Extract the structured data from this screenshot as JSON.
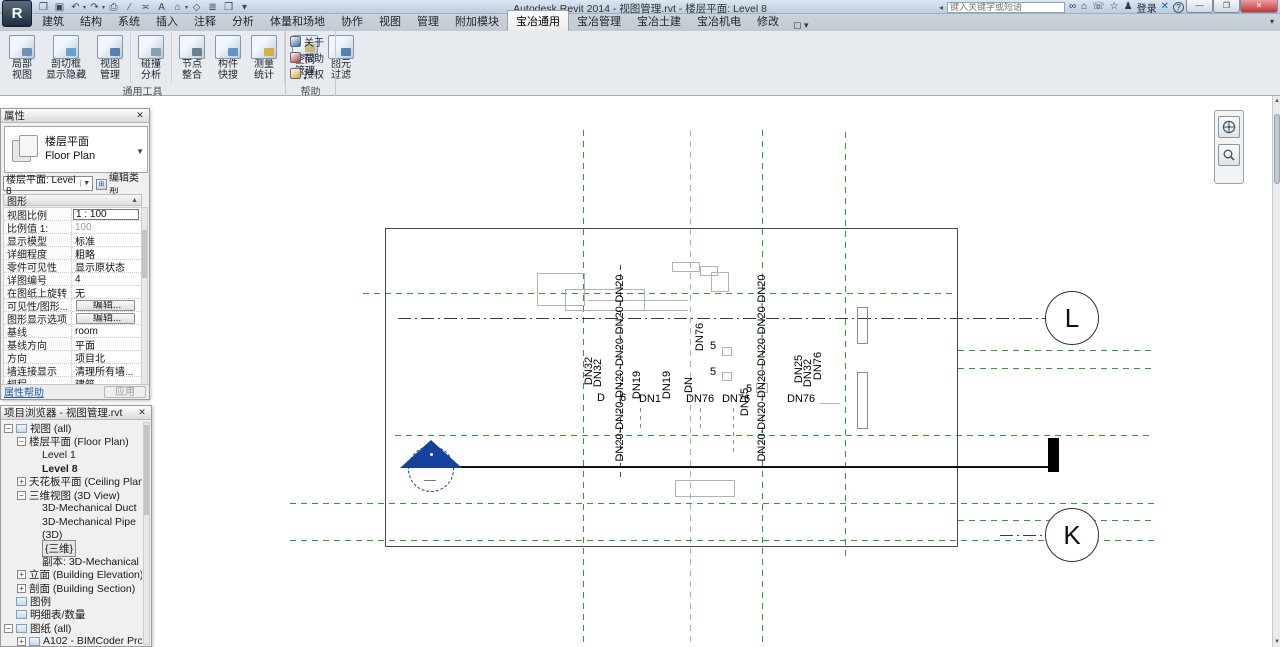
{
  "window": {
    "title": "Autodesk Revit 2014 -    视图管理.rvt - 楼层平面: Level 8",
    "logo_letter": "R",
    "search_placeholder": "键入关键字或短语",
    "signin_label": "登录",
    "min_glyph": "—",
    "max_glyph": "❐",
    "close_glyph": "✕"
  },
  "qat": {
    "icons": [
      {
        "name": "open-file",
        "glyph": "❒"
      },
      {
        "name": "save",
        "glyph": "▣"
      },
      {
        "name": "undo",
        "glyph": "↶",
        "dd": true
      },
      {
        "name": "redo",
        "glyph": "↷",
        "dd": true
      },
      {
        "name": "print",
        "glyph": "⎙"
      },
      {
        "name": "measure",
        "glyph": "∕"
      },
      {
        "name": "aligned-dimension",
        "glyph": "≍"
      },
      {
        "name": "text",
        "glyph": "A"
      },
      {
        "name": "default-3d-view",
        "glyph": "⌂",
        "dd": true
      },
      {
        "name": "section",
        "glyph": "◇"
      },
      {
        "name": "thin-lines",
        "glyph": "≣"
      },
      {
        "name": "close-hidden-windows",
        "glyph": "❐"
      },
      {
        "name": "customize-quick-access",
        "glyph": "▾"
      }
    ]
  },
  "infocenter": {
    "icons": [
      {
        "name": "search",
        "glyph": "∞"
      },
      {
        "name": "subscription-center",
        "glyph": "⌂"
      },
      {
        "name": "communication-center",
        "glyph": "☏"
      },
      {
        "name": "favorites",
        "glyph": "☆"
      },
      {
        "name": "sign-in-avatar",
        "glyph": "♟"
      }
    ],
    "help_glyph": "?"
  },
  "tabs": [
    {
      "label": "建筑"
    },
    {
      "label": "结构"
    },
    {
      "label": "系统"
    },
    {
      "label": "插入"
    },
    {
      "label": "注释"
    },
    {
      "label": "分析"
    },
    {
      "label": "体量和场地"
    },
    {
      "label": "协作"
    },
    {
      "label": "视图"
    },
    {
      "label": "管理"
    },
    {
      "label": "附加模块"
    },
    {
      "label": "宝冶通用",
      "active": true
    },
    {
      "label": "宝冶管理"
    },
    {
      "label": "宝冶土建"
    },
    {
      "label": "宝冶机电"
    },
    {
      "label": "修改"
    }
  ],
  "tab_extra_glyph": "▢ ▾",
  "ribbon_min_glyph": "▾",
  "ribbon": {
    "panels": [
      {
        "name": "通用工具",
        "groups": [
          [
            {
              "name": "partial-view",
              "l1": "局部",
              "l2": "视图",
              "accent": "#5b84ad"
            },
            {
              "name": "section-box-visibility",
              "l1": "剖切框",
              "l2": "显示隐藏",
              "accent": "#4e9ad0",
              "wide": true
            },
            {
              "name": "view-manager",
              "l1": "视图",
              "l2": "管理",
              "accent": "#3f6fa8"
            }
          ],
          [
            {
              "name": "clash-analysis",
              "l1": "碰撞",
              "l2": "分析",
              "accent": "#7d93a8"
            }
          ],
          [
            {
              "name": "node-integration",
              "l1": "节点",
              "l2": "整合",
              "accent": "#5d6d7c"
            },
            {
              "name": "component-quick-search",
              "l1": "构件",
              "l2": "快搜",
              "accent": "#4c86c0"
            },
            {
              "name": "measure-statistics",
              "l1": "测量",
              "l2": "统计",
              "accent": "#d8a62a"
            }
          ],
          [
            {
              "name": "space-management",
              "l1": "空间",
              "l2": "管理",
              "accent": "#c9b06a",
              "dropdown": true
            },
            {
              "name": "element-filter",
              "l1": "图元",
              "l2": "过滤",
              "accent": "#3f6fa8"
            }
          ]
        ]
      },
      {
        "name": "帮助",
        "small_buttons": [
          {
            "name": "about",
            "label": "关于",
            "color": "#2f6fb5"
          },
          {
            "name": "help",
            "label": "帮助",
            "color": "#b03a2e"
          },
          {
            "name": "license",
            "label": "授权",
            "color": "#d8a62a"
          }
        ]
      }
    ]
  },
  "properties": {
    "title": "属性",
    "close_glyph": "✕",
    "type_cn": "楼层平面",
    "type_en": "Floor Plan",
    "selector_value": "楼层平面: Level 8",
    "edit_type_label": "编辑类型",
    "section_graphics": "图形",
    "rows": [
      {
        "label": "视图比例",
        "value": "1 : 100",
        "kind": "input"
      },
      {
        "label": "比例值 1:",
        "value": "100",
        "kind": "disabled"
      },
      {
        "label": "显示模型",
        "value": "标准",
        "kind": "text"
      },
      {
        "label": "详细程度",
        "value": "粗略",
        "kind": "text"
      },
      {
        "label": "零件可见性",
        "value": "显示原状态",
        "kind": "text"
      },
      {
        "label": "详图编号",
        "value": "4",
        "kind": "text"
      },
      {
        "label": "在图纸上旋转",
        "value": "无",
        "kind": "text"
      },
      {
        "label": "可见性/图形...",
        "value": "编辑...",
        "kind": "button"
      },
      {
        "label": "图形显示选项",
        "value": "编辑...",
        "kind": "button"
      },
      {
        "label": "基线",
        "value": "room",
        "kind": "text"
      },
      {
        "label": "基线方向",
        "value": "平面",
        "kind": "text"
      },
      {
        "label": "方向",
        "value": "项目北",
        "kind": "text"
      },
      {
        "label": "墙连接显示",
        "value": "清理所有墙...",
        "kind": "text"
      },
      {
        "label": "规程",
        "value": "建筑",
        "kind": "text"
      }
    ],
    "help_label": "属性帮助",
    "apply_label": "应用"
  },
  "browser": {
    "title": "项目浏览器 - 视图管理.rvt",
    "close_glyph": "✕",
    "tree": [
      {
        "label": "视图 (all)",
        "depth": 0,
        "expand": "-",
        "icon": true
      },
      {
        "label": "楼层平面 (Floor Plan)",
        "depth": 1,
        "expand": "-"
      },
      {
        "label": "Level 1",
        "depth": 2
      },
      {
        "label": "Level 8",
        "depth": 2,
        "bold": true
      },
      {
        "label": "天花板平面 (Ceiling Plan)",
        "depth": 1,
        "expand": "+"
      },
      {
        "label": "三维视图 (3D View)",
        "depth": 1,
        "expand": "-"
      },
      {
        "label": "3D-Mechanical Duct",
        "depth": 2
      },
      {
        "label": "3D-Mechanical Pipe",
        "depth": 2
      },
      {
        "label": "(3D)",
        "depth": 2
      },
      {
        "label": "{三维}",
        "depth": 2,
        "selected": true
      },
      {
        "label": "副本: 3D-Mechanical Du",
        "depth": 2
      },
      {
        "label": "立面 (Building Elevation)",
        "depth": 1,
        "expand": "+"
      },
      {
        "label": "剖面 (Building Section)",
        "depth": 1,
        "expand": "+"
      },
      {
        "label": "图例",
        "depth": 0,
        "icon": true
      },
      {
        "label": "明细表/数量",
        "depth": 0,
        "icon": true
      },
      {
        "label": "图纸 (all)",
        "depth": 0,
        "expand": "-",
        "icon": true
      },
      {
        "label": "A102 - BIMCoder Project",
        "depth": 1,
        "expand": "+",
        "icon": true
      }
    ]
  },
  "drawing": {
    "colors": {
      "grid_green": "#2f9e2f",
      "marker_blue": "#16419c"
    },
    "bubbles": [
      {
        "label": "L",
        "x": 1072,
        "y": 318
      },
      {
        "label": "K",
        "x": 1072,
        "y": 535
      }
    ],
    "labels": [
      {
        "t": "DN20-DN20-DN20-DN20-DN20-DN20",
        "x": 620,
        "y": 368,
        "r": 1
      },
      {
        "t": "DN20-DN20-DN20-DN20-DN20-DN20",
        "x": 762,
        "y": 368,
        "r": 1
      },
      {
        "t": "DN32",
        "x": 589,
        "y": 371,
        "r": 1
      },
      {
        "t": "DN32",
        "x": 598,
        "y": 373,
        "r": 1
      },
      {
        "t": "DN76",
        "x": 700,
        "y": 337,
        "r": 1
      },
      {
        "t": "DN",
        "x": 689,
        "y": 385,
        "r": 1
      },
      {
        "t": "DN19",
        "x": 637,
        "y": 385,
        "r": 1
      },
      {
        "t": "DN19",
        "x": 667,
        "y": 385,
        "r": 1
      },
      {
        "t": "DN15",
        "x": 745,
        "y": 402,
        "r": 1
      },
      {
        "t": "DN25",
        "x": 799,
        "y": 369,
        "r": 1
      },
      {
        "t": "DN32",
        "x": 808,
        "y": 373,
        "r": 1
      },
      {
        "t": "DN76",
        "x": 818,
        "y": 366,
        "r": 1
      },
      {
        "t": "D",
        "x": 601,
        "y": 398
      },
      {
        "t": "6",
        "x": 623,
        "y": 398
      },
      {
        "t": "DN1",
        "x": 650,
        "y": 399
      },
      {
        "t": "DN76",
        "x": 700,
        "y": 399
      },
      {
        "t": "DN76",
        "x": 736,
        "y": 399
      },
      {
        "t": "DN76",
        "x": 801,
        "y": 399
      },
      {
        "t": "5",
        "x": 713,
        "y": 346
      },
      {
        "t": "5",
        "x": 713,
        "y": 372
      },
      {
        "t": "5",
        "x": 749,
        "y": 389
      }
    ]
  }
}
